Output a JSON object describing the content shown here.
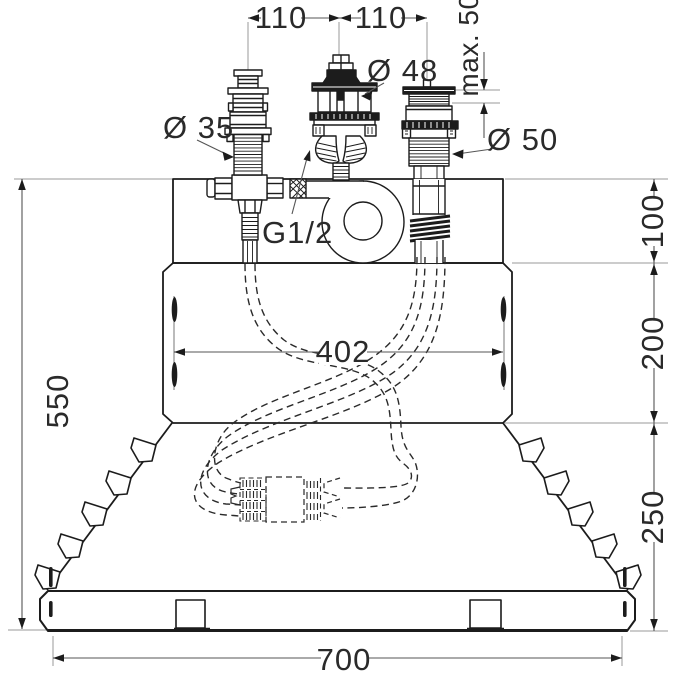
{
  "meta": {
    "background": "#ffffff",
    "line_color": "#1c1c1c",
    "dim_line_color": "#8f8f8f",
    "text_color": "#2a2a2a",
    "drawing_type": "bath-rim-mixer-installation-dimensional-drawing"
  },
  "labels": {
    "spacing_left": "110",
    "spacing_right": "110",
    "max_thickness": "max. 50",
    "dia_center": "Ø 48",
    "dia_left": "Ø 35",
    "dia_right": "Ø 50",
    "thread": "G1/2",
    "height_deck": "100",
    "height_mid": "200",
    "slot_span": "402",
    "height_total": "550",
    "height_lower": "250",
    "width_total": "700"
  }
}
